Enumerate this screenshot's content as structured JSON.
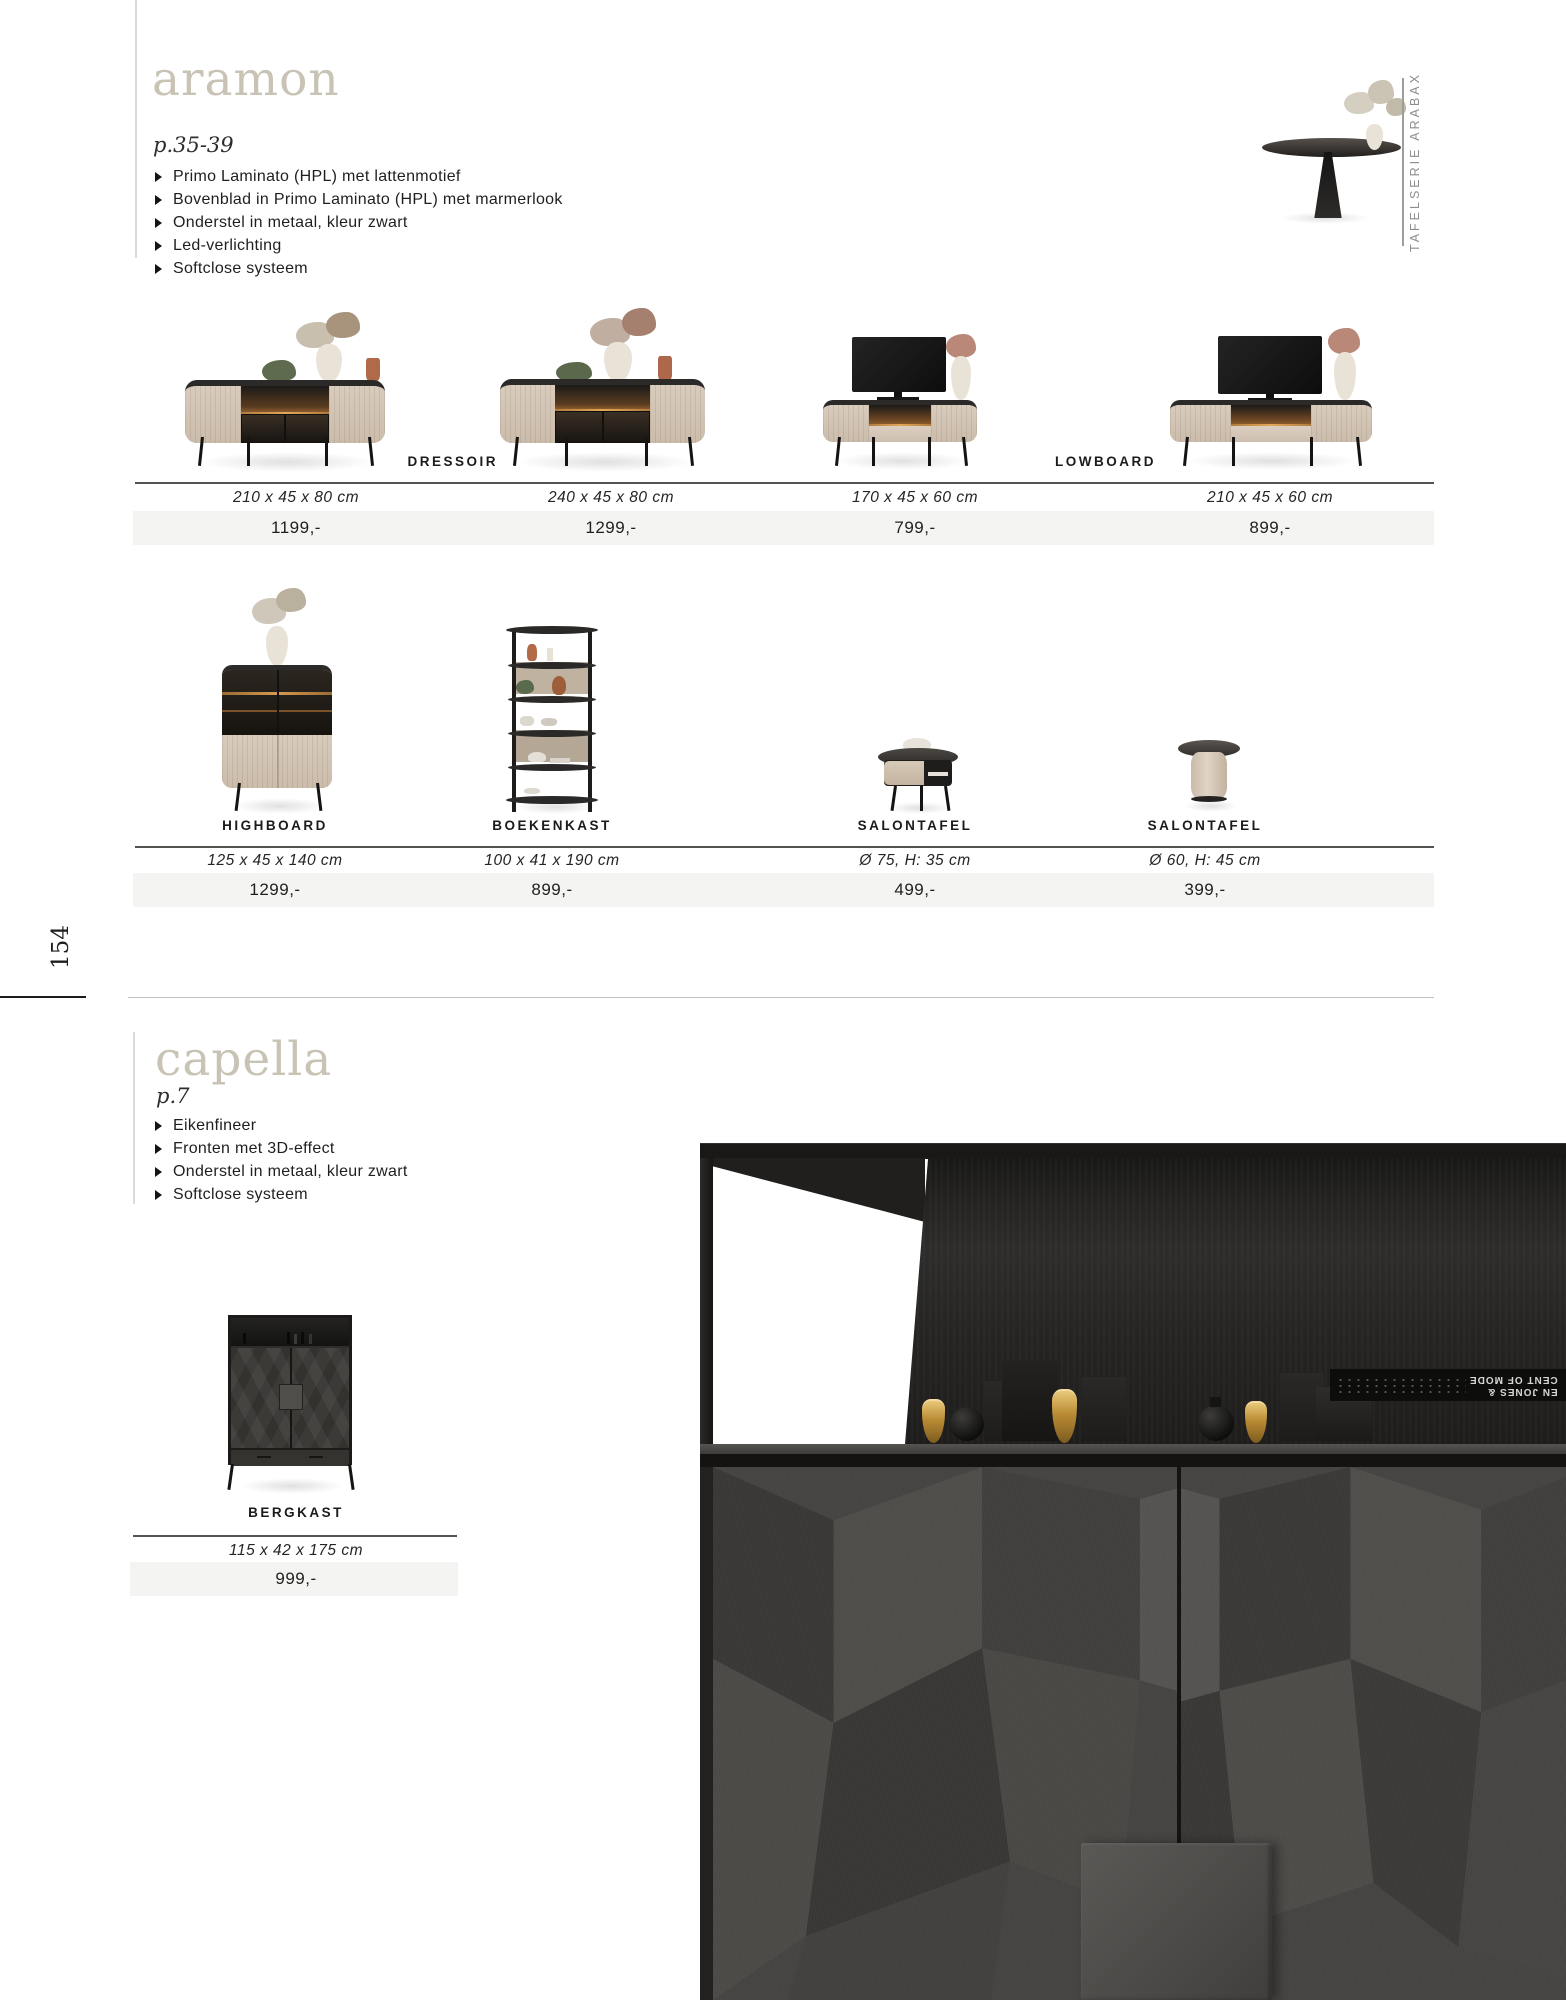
{
  "page": {
    "number": "154"
  },
  "aramon": {
    "title": "aramon",
    "page_ref": "p.35-39",
    "features": [
      "Primo Laminato (HPL) met lattenmotief",
      "Bovenblad in Primo Laminato (HPL) met marmerlook",
      "Onderstel in metaal, kleur zwart",
      "Led-verlichting",
      "Softclose systeem"
    ],
    "side_label": "TAFELSERIE ARABAX",
    "group_labels": {
      "dressoir": "DRESSOIR",
      "lowboard": "LOWBOARD"
    },
    "row1": [
      {
        "dims": "210 x 45 x 80 cm",
        "price": "1199,-"
      },
      {
        "dims": "240 x 45 x 80 cm",
        "price": "1299,-"
      },
      {
        "dims": "170 x 45 x 60 cm",
        "price": "799,-"
      },
      {
        "dims": "210 x 45 x 60 cm",
        "price": "899,-"
      }
    ],
    "row2": [
      {
        "label": "HIGHBOARD",
        "dims": "125 x 45 x 140 cm",
        "price": "1299,-"
      },
      {
        "label": "BOEKENKAST",
        "dims": "100 x 41 x 190 cm",
        "price": "899,-"
      },
      {
        "label": "SALONTAFEL",
        "dims": "Ø 75, H: 35 cm",
        "price": "499,-"
      },
      {
        "label": "SALONTAFEL",
        "dims": "Ø 60, H: 45 cm",
        "price": "399,-"
      }
    ]
  },
  "capella": {
    "title": "capella",
    "page_ref": "p.7",
    "features": [
      "Eikenfineer",
      "Fronten met 3D-effect",
      "Onderstel in metaal, kleur zwart",
      "Softclose systeem"
    ],
    "product": {
      "label": "BERGKAST",
      "dims": "115 x 42 x 175 cm",
      "price": "999,-"
    },
    "photo": {
      "book_line1": "EN JONES &",
      "book_line2": "CENT OF MODE"
    }
  },
  "colors": {
    "accent_title": "#c8c3b4",
    "price_strip": "#f4f4f2",
    "divider": "#55534f"
  }
}
